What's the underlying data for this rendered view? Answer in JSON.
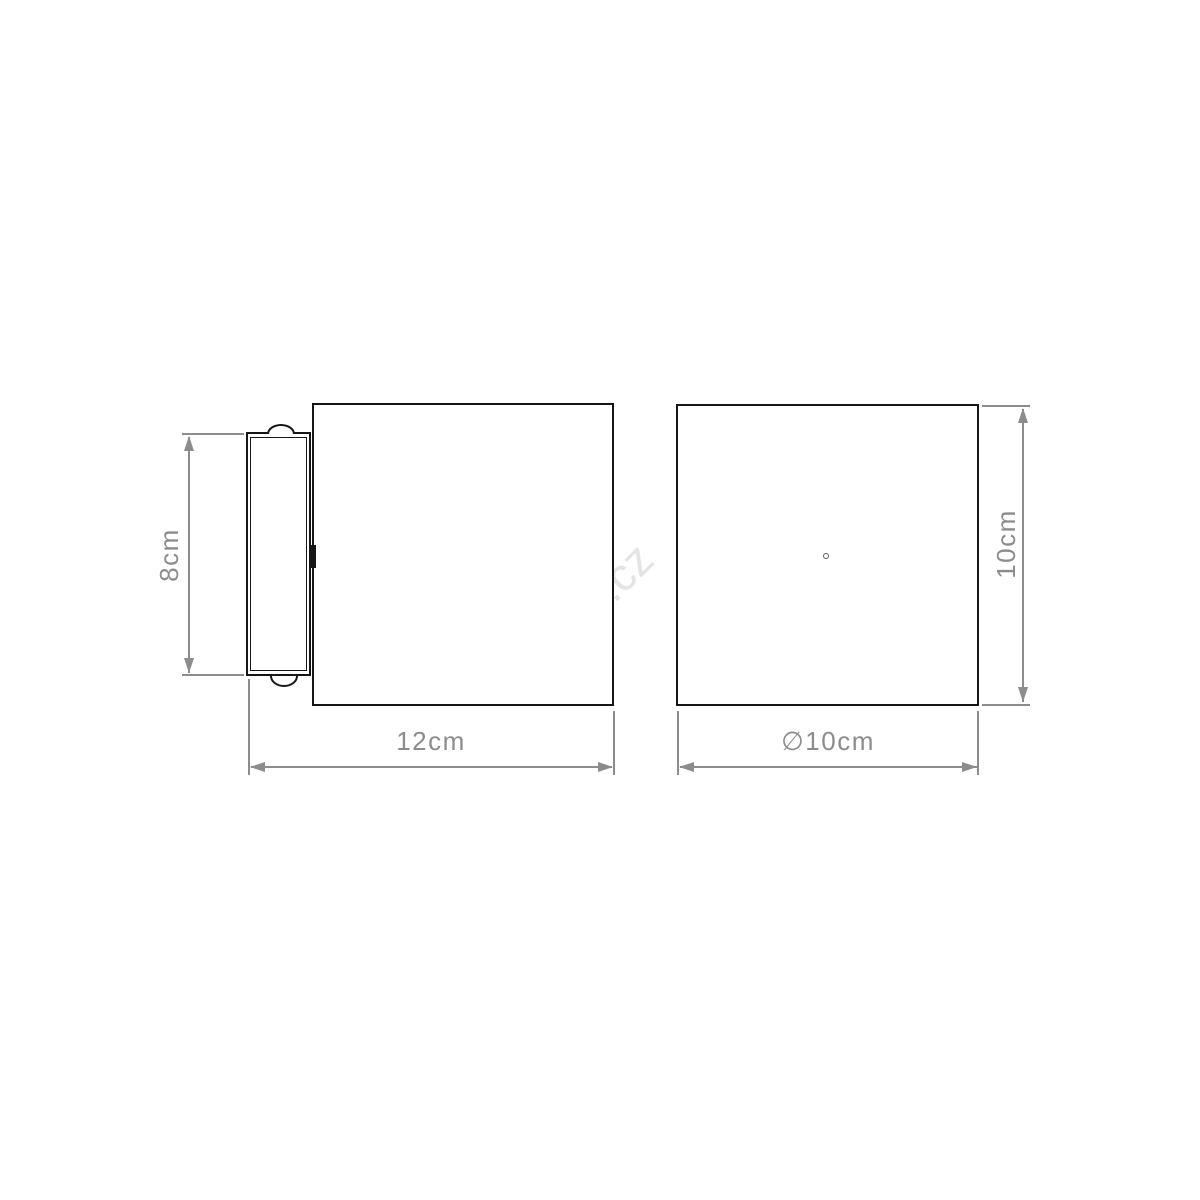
{
  "watermark": "rent.cz",
  "side_view": {
    "title": "side view of wall light with mounting plate",
    "height_dimension": "8cm",
    "width_dimension": "12cm"
  },
  "front_view": {
    "title": "front view of wall light",
    "height_dimension": "10cm",
    "diameter_dimension": "∅10cm"
  },
  "colors": {
    "outline_black": "#161616",
    "dimension_gray": "#8c8c8c",
    "watermark_gray": "#e4e4e4",
    "background": "#ffffff"
  }
}
